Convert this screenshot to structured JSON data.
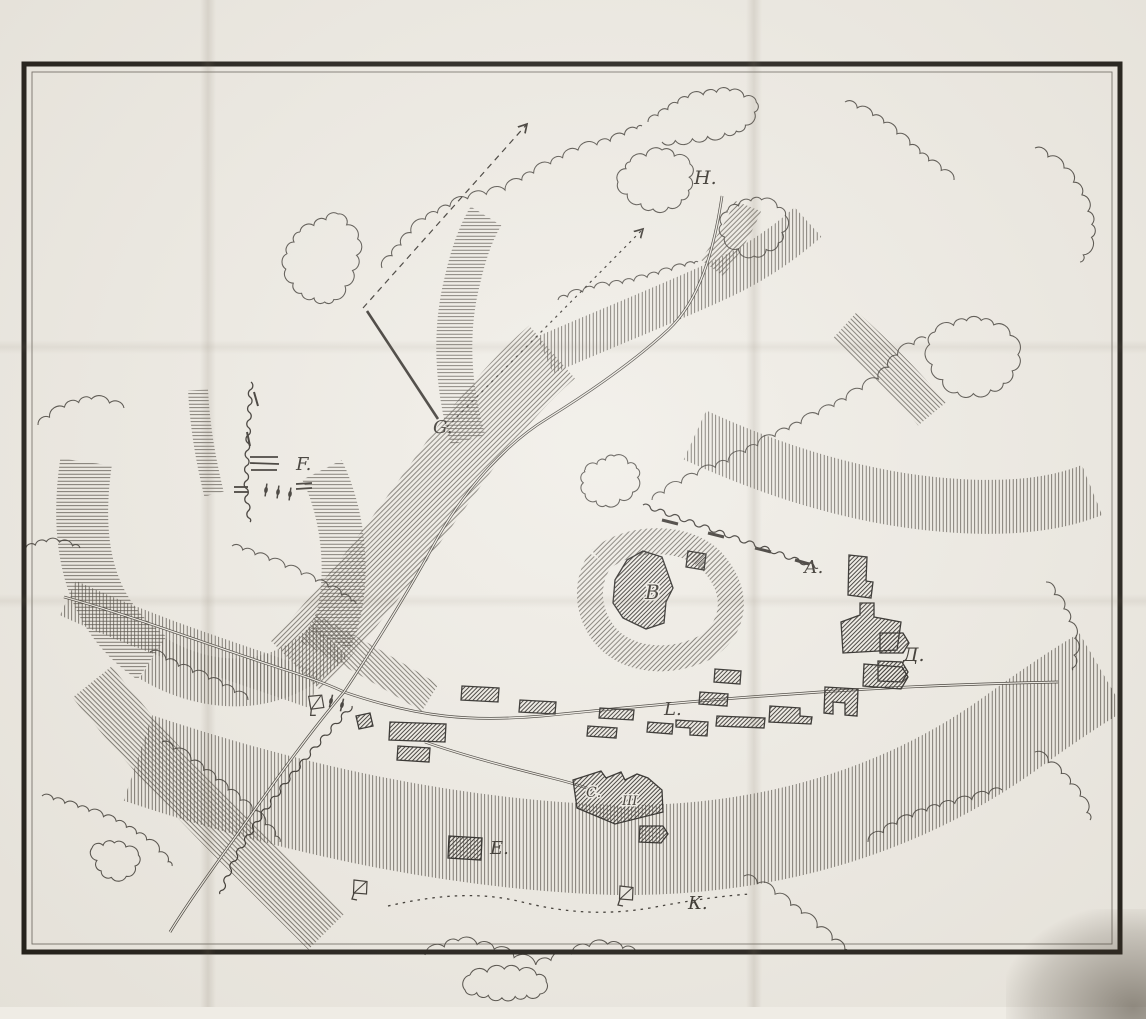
{
  "header": {
    "left_title": "Изъ дневника Барона Л. П. Николаи.",
    "right_title": "Къ ст. IX. №2, Набѣгъ на аулъ КАРА-СУ."
  },
  "map": {
    "markers": [
      {
        "label": "Н.",
        "x": 694,
        "y": 184,
        "size": 19
      },
      {
        "label": "G.",
        "x": 433,
        "y": 433,
        "size": 18
      },
      {
        "label": "F.",
        "x": 296,
        "y": 470,
        "size": 18
      },
      {
        "label": "А.",
        "x": 804,
        "y": 573,
        "size": 18
      },
      {
        "label": "В",
        "x": 645,
        "y": 599,
        "size": 20,
        "in_building": true
      },
      {
        "label": "Д.",
        "x": 903,
        "y": 661,
        "size": 19
      },
      {
        "label": "L.",
        "x": 664,
        "y": 715,
        "size": 18
      },
      {
        "label": "С.",
        "x": 586,
        "y": 797,
        "size": 14,
        "in_building": true
      },
      {
        "label": "III",
        "x": 622,
        "y": 805,
        "size": 13,
        "in_building": true
      },
      {
        "label": "Е.",
        "x": 490,
        "y": 854,
        "size": 18
      },
      {
        "label": "К.",
        "x": 688,
        "y": 909,
        "size": 18
      }
    ],
    "flags": [
      {
        "x": 312,
        "y": 712,
        "rot": -12
      },
      {
        "x": 354,
        "y": 896,
        "rot": 0
      },
      {
        "x": 620,
        "y": 902,
        "rot": 0
      }
    ],
    "cannons": [
      {
        "x": 331,
        "y": 701,
        "rot": 14
      },
      {
        "x": 342,
        "y": 705,
        "rot": 14
      },
      {
        "x": 266,
        "y": 490,
        "rot": 8
      },
      {
        "x": 278,
        "y": 492,
        "rot": 8
      },
      {
        "x": 290,
        "y": 494,
        "rot": 8
      }
    ],
    "colors": {
      "ink": "#2f2b26",
      "paper": "#efece5",
      "hatch": "#48433b"
    }
  }
}
